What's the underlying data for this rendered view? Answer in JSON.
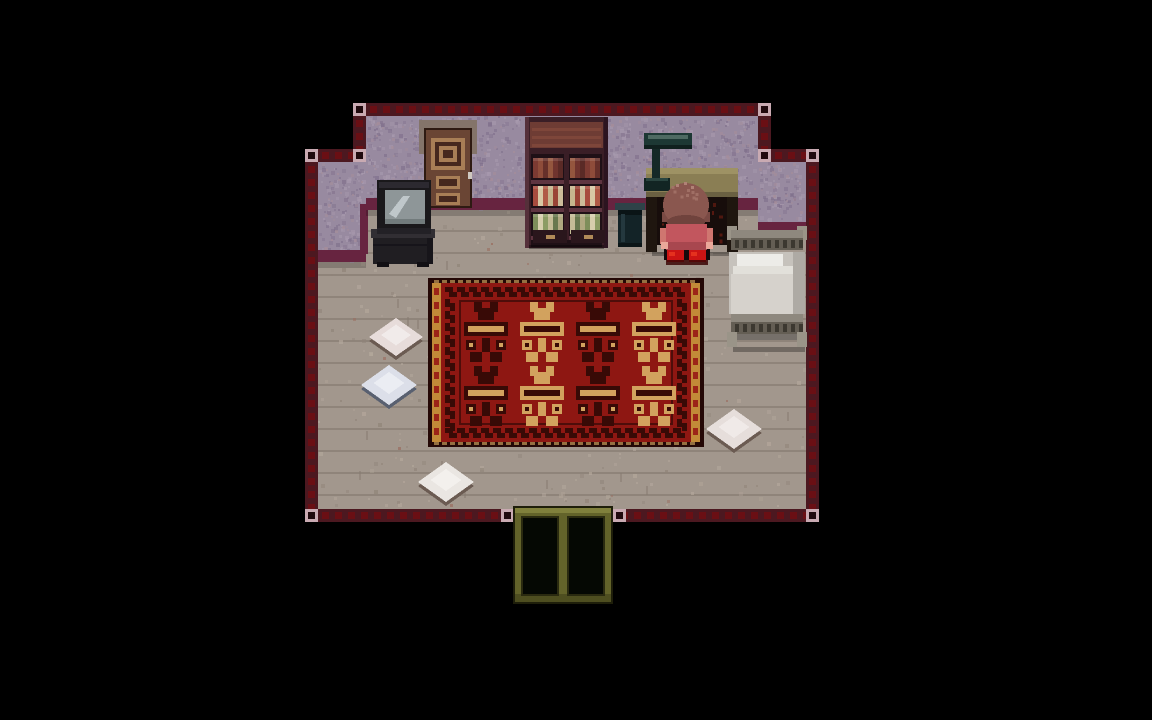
{
  "scene": {
    "name": "bedroom-interior",
    "title": "Top-down pixel-art bedroom (RPG game screen)",
    "viewport": {
      "width": 1152,
      "height": 720
    }
  },
  "palette": {
    "background": "#000000",
    "border_band": "#4c1820",
    "border_dot": "#6a0f14",
    "border_corner_outline": "#c9aab2",
    "border_corner_fill": "#200a0e",
    "wall_base": "#988aa0",
    "wall_speck_light": "#a89aae",
    "wall_speck_dark": "#80708c",
    "wall_speck_pink": "#a68e9a",
    "baseboard": "#672440",
    "floor_base": "#a2978d",
    "floor_line": "#857a70",
    "floor_speck_light": "#b4a89c",
    "floor_speck_dark": "#8f8378",
    "floor_speck_red": "#9a6a5c"
  },
  "room": {
    "border": {
      "thickness": 13,
      "bands": [
        [
          353,
          103,
          418,
          13
        ],
        [
          353,
          103,
          13,
          59
        ],
        [
          758,
          103,
          13,
          59
        ],
        [
          305,
          149,
          61,
          13
        ],
        [
          758,
          149,
          61,
          13
        ],
        [
          305,
          149,
          13,
          373
        ],
        [
          806,
          149,
          13,
          373
        ],
        [
          305,
          509,
          514,
          13
        ]
      ],
      "corners": [
        [
          353,
          103
        ],
        [
          758,
          103
        ],
        [
          305,
          149
        ],
        [
          353,
          149
        ],
        [
          758,
          149
        ],
        [
          806,
          149
        ],
        [
          305,
          509
        ],
        [
          806,
          509
        ],
        [
          501,
          509
        ],
        [
          613,
          509
        ]
      ]
    },
    "walls": [
      [
        366,
        116,
        392,
        94
      ],
      [
        318,
        162,
        48,
        100
      ],
      [
        758,
        162,
        48,
        66
      ]
    ],
    "baseboards": [
      [
        366,
        198,
        392,
        12
      ],
      [
        318,
        250,
        48,
        12
      ],
      [
        360,
        204,
        8,
        50
      ],
      [
        758,
        222,
        48,
        10
      ]
    ],
    "floor": [
      318,
      210,
      488,
      299
    ],
    "plank_step": 22
  },
  "sprites": {
    "wall_door": {
      "x": 419,
      "y": 120,
      "w": 58,
      "h": 88,
      "lintel": "#84746a",
      "slab": "#6a4534",
      "outline": "#2e1a12",
      "panel_light": "#a87e56",
      "panel_dark": "#46281e",
      "knob": "#cfc8c0"
    },
    "bookshelf": {
      "x": 525,
      "y": 117,
      "w": 83,
      "h": 131,
      "frame": "#3a1e26",
      "top_panel": "#6e3c34",
      "top_slat": "#7e463a",
      "shelf_bg": "#1f1016",
      "board": "#5e3440",
      "drawer": "#2a161c",
      "handle": "#b08a58",
      "book_rows": [
        [
          "#7c3a32",
          "#8e4c3a",
          "#66302a",
          "#94563e",
          "#70342e",
          "#5a2a26"
        ],
        [
          "#a84c3e",
          "#d8c8a4",
          "#b05a46",
          "#c6b68e",
          "#9a4436",
          "#ccbc9a"
        ],
        [
          "#7e8e5a",
          "#d6ceac",
          "#8c9c64",
          "#c4bc96",
          "#68784e",
          "#b0a880"
        ]
      ]
    },
    "tv": {
      "x": 371,
      "y": 180,
      "body": "#1a181b",
      "bevel": "#2c2930",
      "screen": "#8e9698",
      "streak": "#c8d0d2",
      "screen_shade": "#6c7476",
      "stand_top": "#312e33",
      "stand_body": "#201e22",
      "leg": "#121014"
    },
    "desk": {
      "x": 646,
      "y": 168,
      "w": 92,
      "top": "#8a7e54",
      "top_light": "#9e9264",
      "lip": "#6a6042",
      "leg": "#1f160f",
      "opening": "#170d0b",
      "ember": "#6a1c12"
    },
    "lamp": {
      "x": 644,
      "y": 133,
      "head": "#1d3834",
      "head_light": "#4e6a62",
      "head_dark": "#10201e",
      "pole": "#152927",
      "base": "#122523",
      "base_light": "#2a4540"
    },
    "trash_bin": {
      "x": 615,
      "y": 203,
      "rim": "#2e4248",
      "body": "#132327",
      "inner": "#0a1416",
      "highlight": "#24383e"
    },
    "character": {
      "cx": 686,
      "cy": 205,
      "hair": "#8a574f",
      "hair_shade": "#70433d",
      "hair_light": "#a5756a",
      "hair_spark": "#b08276",
      "pigtail": "#7a4a44",
      "body": "#c2565e",
      "body_shade": "#a8474f",
      "arm": "#cf7670",
      "hand": "#eaa89a",
      "shoe": "#cc1414",
      "shoe_shadow": "#3c0606",
      "seat": "#150a0c"
    },
    "bed": {
      "x": 727,
      "y": 226,
      "w": 80,
      "h": 124,
      "post": "#9a9488",
      "rail": "#8e887e",
      "slat_band": "#645e54",
      "slat_dot": "#3c3830",
      "mattress": "#c6c2bc",
      "pillow": "#edece8",
      "fold": "#e2e0da",
      "blanket": "#d6d2cc",
      "shade": "#aeaaa4",
      "foot_rail": "#76706a"
    },
    "rug": {
      "x": 428,
      "y": 278,
      "w": 276,
      "h": 169,
      "edge": "#240806",
      "gold": "#c28a38",
      "gold_dash": "#9c2418",
      "field": "#8e1712",
      "meander": "#380a06",
      "field_line": "#4e0d0a",
      "motif_dark": "#380a06",
      "motif_tan": "#d2a25e",
      "fringe_dash": "#b08a50"
    },
    "cushions": [
      {
        "cx": 396,
        "cy": 337,
        "w": 54,
        "h": 38,
        "tint": "#e7dcda",
        "hi": "#f2eceb",
        "shade": "#6b5b52"
      },
      {
        "cx": 389,
        "cy": 385,
        "w": 56,
        "h": 40,
        "tint": "#dcdfe9",
        "hi": "#eceef4",
        "shade": "#596070"
      },
      {
        "cx": 734,
        "cy": 429,
        "w": 56,
        "h": 40,
        "tint": "#e6dedb",
        "hi": "#f1ebe9",
        "shade": "#6b5b52"
      },
      {
        "cx": 446,
        "cy": 482,
        "w": 56,
        "h": 40,
        "tint": "#eae6e2",
        "hi": "#f4f1ee",
        "shade": "#6b5b52"
      }
    ],
    "balcony_door": {
      "x": 513,
      "y": 506,
      "w": 100,
      "h": 98,
      "frame": "#63632a",
      "frame_light": "#80803c",
      "frame_dark": "#4e4e20",
      "pane": "#050803",
      "outline": "#1e1e0a"
    }
  }
}
